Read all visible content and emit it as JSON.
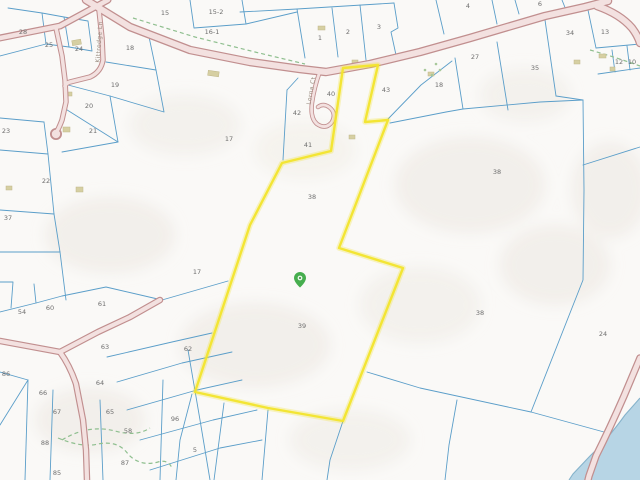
{
  "map": {
    "colors": {
      "highlight": "#f2e42c",
      "parcel_line": "#5b9ec9",
      "road_fill": "#f3e1e0",
      "road_casing": "#c18f8f",
      "water": "#b7d5e5",
      "trail": "#8fbf8f",
      "marker": "#46ae4e"
    },
    "road_labels": [
      {
        "name": "Kittredge Ln"
      },
      {
        "name": "Lorna Ct"
      }
    ],
    "highlighted_parcel": {
      "labels": [
        "38",
        "39"
      ]
    },
    "parcels": [
      {
        "label": "15",
        "x": 165,
        "y": 15
      },
      {
        "label": "15-2",
        "x": 216,
        "y": 14
      },
      {
        "label": "16-1",
        "x": 212,
        "y": 34
      },
      {
        "label": "28",
        "x": 23,
        "y": 34
      },
      {
        "label": "25",
        "x": 49,
        "y": 47
      },
      {
        "label": "24",
        "x": 79,
        "y": 51
      },
      {
        "label": "18",
        "x": 130,
        "y": 50
      },
      {
        "label": "1",
        "x": 320,
        "y": 40
      },
      {
        "label": "2",
        "x": 348,
        "y": 34
      },
      {
        "label": "3",
        "x": 379,
        "y": 29
      },
      {
        "label": "4",
        "x": 468,
        "y": 8
      },
      {
        "label": "6",
        "x": 540,
        "y": 6
      },
      {
        "label": "34",
        "x": 570,
        "y": 35
      },
      {
        "label": "13",
        "x": 605,
        "y": 34
      },
      {
        "label": "27",
        "x": 475,
        "y": 59
      },
      {
        "label": "35",
        "x": 535,
        "y": 70
      },
      {
        "label": "12",
        "x": 619,
        "y": 64
      },
      {
        "label": "10",
        "x": 632,
        "y": 64
      },
      {
        "label": "19",
        "x": 115,
        "y": 87
      },
      {
        "label": "20",
        "x": 89,
        "y": 108
      },
      {
        "label": "40",
        "x": 331,
        "y": 96
      },
      {
        "label": "42",
        "x": 297,
        "y": 115
      },
      {
        "label": "43",
        "x": 386,
        "y": 92
      },
      {
        "label": "18",
        "x": 439,
        "y": 87
      },
      {
        "label": "21",
        "x": 93,
        "y": 133
      },
      {
        "label": "23",
        "x": 6,
        "y": 133
      },
      {
        "label": "41",
        "x": 308,
        "y": 147
      },
      {
        "label": "17",
        "x": 229,
        "y": 141
      },
      {
        "label": "22",
        "x": 46,
        "y": 183
      },
      {
        "label": "37",
        "x": 8,
        "y": 220
      },
      {
        "label": "38",
        "x": 312,
        "y": 199
      },
      {
        "label": "38",
        "x": 497,
        "y": 174
      },
      {
        "label": "17",
        "x": 197,
        "y": 274
      },
      {
        "label": "39",
        "x": 302,
        "y": 328
      },
      {
        "label": "38",
        "x": 480,
        "y": 315
      },
      {
        "label": "24",
        "x": 603,
        "y": 336
      },
      {
        "label": "54",
        "x": 22,
        "y": 314
      },
      {
        "label": "60",
        "x": 50,
        "y": 310
      },
      {
        "label": "61",
        "x": 102,
        "y": 306
      },
      {
        "label": "63",
        "x": 105,
        "y": 349
      },
      {
        "label": "62",
        "x": 188,
        "y": 351
      },
      {
        "label": "86",
        "x": 6,
        "y": 376
      },
      {
        "label": "64",
        "x": 100,
        "y": 385
      },
      {
        "label": "66",
        "x": 43,
        "y": 395
      },
      {
        "label": "67",
        "x": 57,
        "y": 414
      },
      {
        "label": "65",
        "x": 110,
        "y": 414
      },
      {
        "label": "96",
        "x": 175,
        "y": 421
      },
      {
        "label": "58",
        "x": 128,
        "y": 433
      },
      {
        "label": "88",
        "x": 45,
        "y": 445
      },
      {
        "label": "87",
        "x": 125,
        "y": 465
      },
      {
        "label": "85",
        "x": 57,
        "y": 475
      },
      {
        "label": "5",
        "x": 195,
        "y": 452
      }
    ]
  }
}
